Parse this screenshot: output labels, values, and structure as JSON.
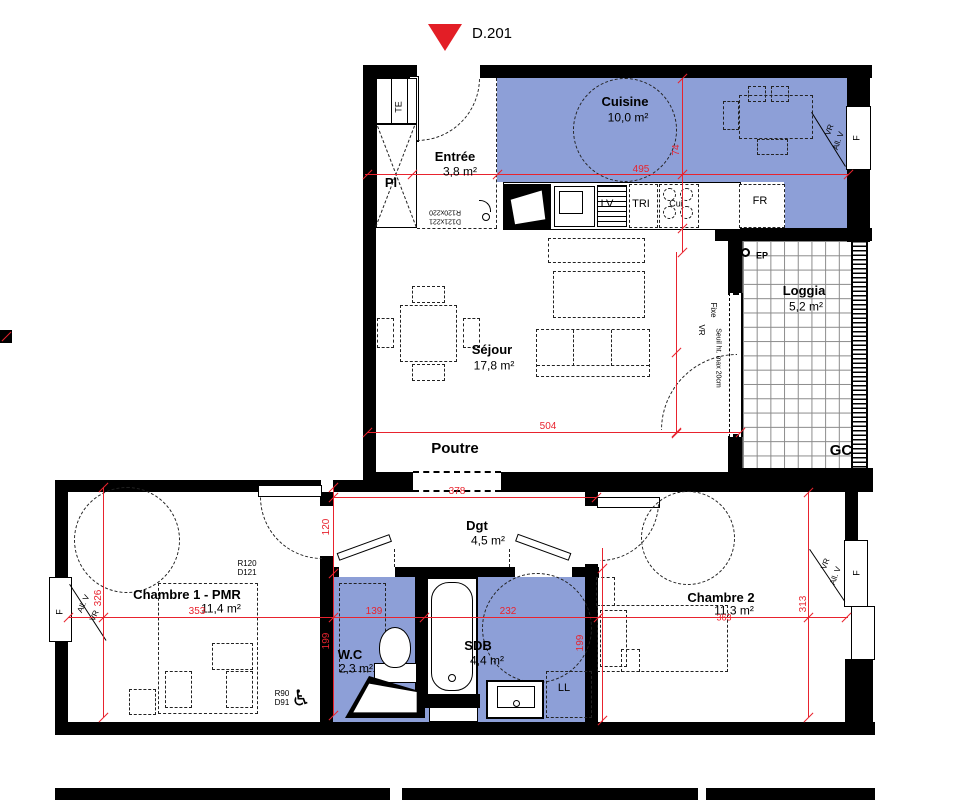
{
  "plan": {
    "title": "D.201",
    "marker_color": "#e31e26",
    "wet_zone_color": "#8d9fd7",
    "dimension_color": "#e8232e",
    "rooms": [
      {
        "name": "Entrée",
        "area": "3,8 m²"
      },
      {
        "name": "Cuisine",
        "area": "10,0 m²"
      },
      {
        "name": "Séjour",
        "area": "17,8 m²"
      },
      {
        "name": "Loggia",
        "area": "5,2 m²"
      },
      {
        "name": "Chambre 1 - PMR",
        "area": "11,4 m²"
      },
      {
        "name": "Dgt",
        "area": "4,5 m²"
      },
      {
        "name": "W.C",
        "area": "2,3 m²"
      },
      {
        "name": "SDB",
        "area": "4,4 m²"
      },
      {
        "name": "Chambre 2",
        "area": "11,3 m²"
      }
    ],
    "labels": [
      {
        "n": "unit-number",
        "t": "D.201",
        "x": 492,
        "y": 34,
        "s": 15,
        "c": "k",
        "b": 0
      },
      {
        "n": "room-cuisine",
        "t": "Cuisine",
        "x": 625,
        "y": 102,
        "s": 13,
        "c": "k",
        "b": 1
      },
      {
        "n": "area-cuisine",
        "t": "10,0 m²",
        "x": 628,
        "y": 118,
        "s": 12,
        "c": "k",
        "b": 0
      },
      {
        "n": "room-entree",
        "t": "Entrée",
        "x": 455,
        "y": 157,
        "s": 13,
        "c": "k",
        "b": 1
      },
      {
        "n": "area-entree",
        "t": "3,8 m²",
        "x": 460,
        "y": 172,
        "s": 12,
        "c": "k",
        "b": 0
      },
      {
        "n": "room-sejour",
        "t": "Séjour",
        "x": 492,
        "y": 350,
        "s": 13,
        "c": "k",
        "b": 1
      },
      {
        "n": "area-sejour",
        "t": "17,8 m²",
        "x": 494,
        "y": 366,
        "s": 12,
        "c": "k",
        "b": 0
      },
      {
        "n": "room-loggia",
        "t": "Loggia",
        "x": 804,
        "y": 291,
        "s": 13,
        "c": "k",
        "b": 1
      },
      {
        "n": "area-loggia",
        "t": "5,2 m²",
        "x": 806,
        "y": 307,
        "s": 12,
        "c": "k",
        "b": 0
      },
      {
        "n": "label-poutre",
        "t": "Poutre",
        "x": 455,
        "y": 449,
        "s": 15,
        "c": "k",
        "b": 1
      },
      {
        "n": "label-gc",
        "t": "GC",
        "x": 841,
        "y": 451,
        "s": 15,
        "c": "k",
        "b": 1
      },
      {
        "n": "label-pl",
        "t": "Pl",
        "x": 391,
        "y": 183,
        "s": 13,
        "c": "k",
        "b": 1
      },
      {
        "n": "label-te",
        "t": "TE",
        "x": 399,
        "y": 107,
        "s": 9,
        "c": "k",
        "b": 0,
        "r": -90
      },
      {
        "n": "label-fr",
        "t": "FR",
        "x": 760,
        "y": 202,
        "s": 11,
        "c": "k",
        "b": 0
      },
      {
        "n": "label-lv",
        "t": "LV",
        "x": 607,
        "y": 205,
        "s": 11,
        "c": "k",
        "b": 0
      },
      {
        "n": "label-tri",
        "t": "TRI",
        "x": 641,
        "y": 205,
        "s": 11,
        "c": "k",
        "b": 0
      },
      {
        "n": "label-cui",
        "t": "Cui",
        "x": 676,
        "y": 204,
        "s": 9,
        "c": "k",
        "b": 0
      },
      {
        "n": "label-ll",
        "t": "LL",
        "x": 564,
        "y": 689,
        "s": 11,
        "c": "k",
        "b": 0
      },
      {
        "n": "label-ep",
        "t": "EP",
        "x": 762,
        "y": 256,
        "s": 9,
        "c": "k",
        "b": 1
      },
      {
        "n": "room-chambre1",
        "t": "Chambre 1 - PMR",
        "x": 187,
        "y": 595,
        "s": 13,
        "c": "k",
        "b": 1
      },
      {
        "n": "area-chambre1",
        "t": "11,4 m²",
        "x": 221,
        "y": 609,
        "s": 12,
        "c": "k",
        "b": 0
      },
      {
        "n": "room-dgt",
        "t": "Dgt",
        "x": 477,
        "y": 526,
        "s": 13,
        "c": "k",
        "b": 1
      },
      {
        "n": "area-dgt",
        "t": "4,5 m²",
        "x": 488,
        "y": 541,
        "s": 12,
        "c": "k",
        "b": 0
      },
      {
        "n": "room-wc",
        "t": "W.C",
        "x": 350,
        "y": 655,
        "s": 13,
        "c": "k",
        "b": 1
      },
      {
        "n": "area-wc",
        "t": "2,3 m²",
        "x": 356,
        "y": 669,
        "s": 12,
        "c": "k",
        "b": 0
      },
      {
        "n": "room-sdb",
        "t": "SDB",
        "x": 478,
        "y": 646,
        "s": 13,
        "c": "k",
        "b": 1
      },
      {
        "n": "area-sdb",
        "t": "4,4 m²",
        "x": 487,
        "y": 661,
        "s": 12,
        "c": "k",
        "b": 0
      },
      {
        "n": "room-chambre2",
        "t": "Chambre 2",
        "x": 721,
        "y": 598,
        "s": 13,
        "c": "k",
        "b": 1
      },
      {
        "n": "area-chambre2",
        "t": "11,3 m²",
        "x": 734,
        "y": 611,
        "s": 12,
        "c": "k",
        "b": 0
      },
      {
        "n": "spec-r120",
        "t": "R120",
        "x": 247,
        "y": 564,
        "s": 8,
        "c": "k",
        "b": 0
      },
      {
        "n": "spec-d121",
        "t": "D121",
        "x": 247,
        "y": 573,
        "s": 8,
        "c": "k",
        "b": 0
      },
      {
        "n": "spec-r90",
        "t": "R90",
        "x": 282,
        "y": 694,
        "s": 8,
        "c": "k",
        "b": 0
      },
      {
        "n": "spec-d91",
        "t": "D91",
        "x": 282,
        "y": 703,
        "s": 8,
        "c": "k",
        "b": 0
      },
      {
        "n": "spec-door-1",
        "t": "R120x220",
        "x": 445,
        "y": 212,
        "s": 7,
        "c": "k",
        "b": 0,
        "r": 180
      },
      {
        "n": "spec-door-2",
        "t": "D121x221",
        "x": 445,
        "y": 221,
        "s": 7,
        "c": "k",
        "b": 0,
        "r": 180
      },
      {
        "n": "win-f-kitchen",
        "t": "F",
        "x": 857,
        "y": 138,
        "s": 9,
        "c": "k",
        "b": 0,
        "r": -90
      },
      {
        "n": "win-vr-kitchen",
        "t": "VR",
        "x": 830,
        "y": 130,
        "s": 8,
        "c": "k",
        "b": 0,
        "r": -70
      },
      {
        "n": "win-allv-kitchen",
        "t": "All. V",
        "x": 839,
        "y": 141,
        "s": 8,
        "c": "k",
        "b": 0,
        "r": -70
      },
      {
        "n": "win-f-ch1",
        "t": "F",
        "x": 60,
        "y": 612,
        "s": 9,
        "c": "k",
        "b": 0,
        "r": -90
      },
      {
        "n": "win-allv-ch1",
        "t": "All. V",
        "x": 84,
        "y": 604,
        "s": 8,
        "c": "k",
        "b": 0,
        "r": -65
      },
      {
        "n": "win-vr-ch1",
        "t": "VR",
        "x": 95,
        "y": 616,
        "s": 8,
        "c": "k",
        "b": 0,
        "r": -65
      },
      {
        "n": "win-f-ch2",
        "t": "F",
        "x": 857,
        "y": 573,
        "s": 9,
        "c": "k",
        "b": 0,
        "r": -90
      },
      {
        "n": "win-vr-ch2",
        "t": "VR",
        "x": 826,
        "y": 564,
        "s": 8,
        "c": "k",
        "b": 0,
        "r": -70
      },
      {
        "n": "win-allv-ch2",
        "t": "All. V",
        "x": 836,
        "y": 576,
        "s": 8,
        "c": "k",
        "b": 0,
        "r": -70
      },
      {
        "n": "bay-fixe",
        "t": "Fixe",
        "x": 713,
        "y": 310,
        "s": 8,
        "c": "k",
        "b": 0,
        "r": 90
      },
      {
        "n": "bay-seuil",
        "t": "Seuil ht. max 20cm",
        "x": 718,
        "y": 358,
        "s": 7,
        "c": "k",
        "b": 0,
        "r": 90
      },
      {
        "n": "bay-vr",
        "t": "VR",
        "x": 701,
        "y": 330,
        "s": 8,
        "c": "k",
        "b": 0,
        "r": 90
      },
      {
        "n": "dim-495",
        "t": "495",
        "x": 641,
        "y": 170,
        "s": 10,
        "c": "r",
        "b": 0
      },
      {
        "n": "dim-74",
        "t": "74",
        "x": 677,
        "y": 150,
        "s": 10,
        "c": "r",
        "b": 0,
        "r": -90
      },
      {
        "n": "dim-504",
        "t": "504",
        "x": 548,
        "y": 427,
        "s": 10,
        "c": "r",
        "b": 0
      },
      {
        "n": "dim-378",
        "t": "378",
        "x": 457,
        "y": 492,
        "s": 10,
        "c": "r",
        "b": 0
      },
      {
        "n": "dim-120",
        "t": "120",
        "x": 327,
        "y": 527,
        "s": 10,
        "c": "r",
        "b": 0,
        "r": -90
      },
      {
        "n": "dim-199-wc",
        "t": "199",
        "x": 327,
        "y": 641,
        "s": 10,
        "c": "r",
        "b": 0,
        "r": -90
      },
      {
        "n": "dim-326",
        "t": "326",
        "x": 99,
        "y": 598,
        "s": 10,
        "c": "r",
        "b": 0,
        "r": -90
      },
      {
        "n": "dim-353",
        "t": "353",
        "x": 197,
        "y": 612,
        "s": 10,
        "c": "r",
        "b": 0
      },
      {
        "n": "dim-139",
        "t": "139",
        "x": 374,
        "y": 612,
        "s": 10,
        "c": "r",
        "b": 0
      },
      {
        "n": "dim-232",
        "t": "232",
        "x": 508,
        "y": 612,
        "s": 10,
        "c": "r",
        "b": 0
      },
      {
        "n": "dim-363",
        "t": "363",
        "x": 724,
        "y": 618,
        "s": 9,
        "c": "r",
        "b": 0
      },
      {
        "n": "dim-313",
        "t": "313",
        "x": 804,
        "y": 604,
        "s": 10,
        "c": "r",
        "b": 0,
        "r": -90
      },
      {
        "n": "dim-199-sdb",
        "t": "199",
        "x": 581,
        "y": 643,
        "s": 10,
        "c": "r",
        "b": 0,
        "r": -90
      },
      {
        "n": "icon-wheelchair",
        "t": "♿",
        "x": 301,
        "y": 698,
        "s": 22,
        "c": "k",
        "b": 0
      }
    ],
    "dim_lines": [
      {
        "x": 365,
        "y": 174,
        "len": 483,
        "o": "h"
      },
      {
        "x": 682,
        "y": 78,
        "len": 174,
        "o": "v"
      },
      {
        "x": 676,
        "y": 252,
        "len": 181,
        "o": "v"
      },
      {
        "x": 367,
        "y": 432,
        "len": 373,
        "o": "h"
      },
      {
        "x": 333,
        "y": 497,
        "len": 263,
        "o": "h"
      },
      {
        "x": 333,
        "y": 487,
        "len": 228,
        "o": "v"
      },
      {
        "x": 68,
        "y": 617,
        "len": 780,
        "o": "h"
      },
      {
        "x": 103,
        "y": 487,
        "len": 230,
        "o": "v"
      },
      {
        "x": 808,
        "y": 492,
        "len": 225,
        "o": "v"
      },
      {
        "x": 602,
        "y": 548,
        "len": 174,
        "o": "v"
      }
    ],
    "ticks": [
      [
        367,
        174
      ],
      [
        412,
        174
      ],
      [
        497,
        174
      ],
      [
        682,
        174
      ],
      [
        848,
        174
      ],
      [
        682,
        78
      ],
      [
        682,
        228
      ],
      [
        682,
        252
      ],
      [
        676,
        352
      ],
      [
        676,
        433
      ],
      [
        367,
        432
      ],
      [
        676,
        432
      ],
      [
        740,
        432
      ],
      [
        333,
        497
      ],
      [
        596,
        497
      ],
      [
        333,
        487
      ],
      [
        333,
        573
      ],
      [
        333,
        715
      ],
      [
        68,
        617
      ],
      [
        103,
        617
      ],
      [
        333,
        617
      ],
      [
        424,
        617
      ],
      [
        598,
        617
      ],
      [
        808,
        617
      ],
      [
        846,
        617
      ],
      [
        103,
        487
      ],
      [
        103,
        717
      ],
      [
        808,
        492
      ],
      [
        808,
        717
      ],
      [
        602,
        568
      ],
      [
        602,
        720
      ],
      [
        6,
        336
      ]
    ]
  }
}
